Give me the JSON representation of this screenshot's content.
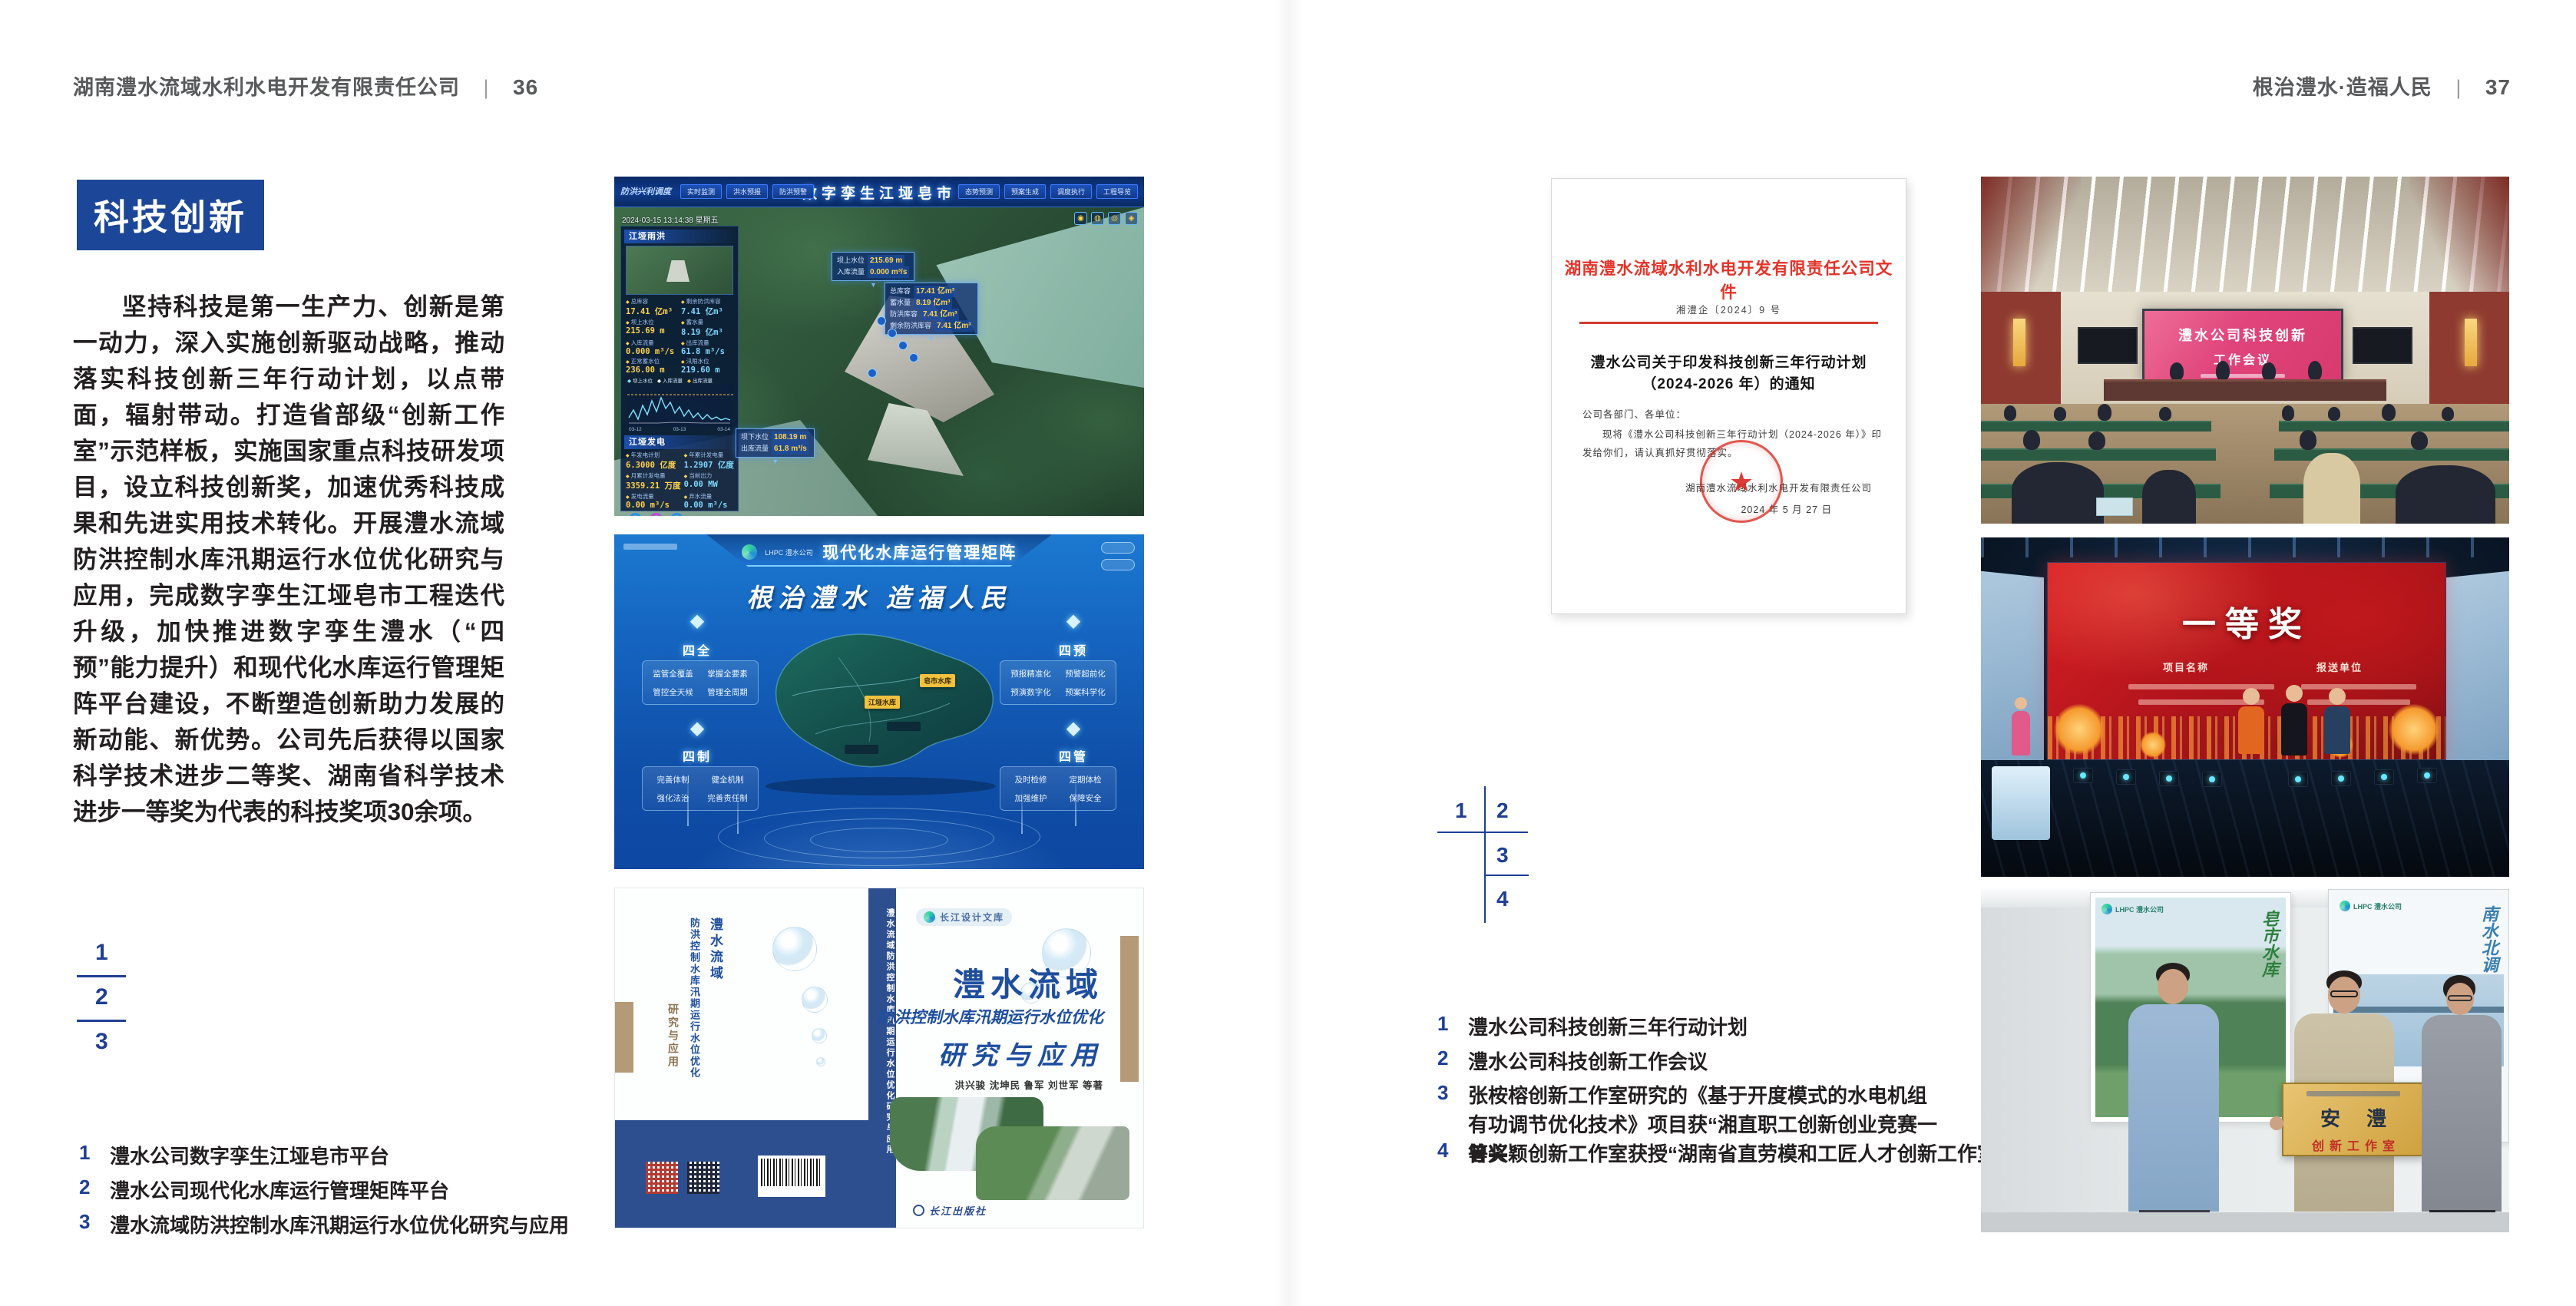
{
  "colors": {
    "accent_blue": "#1c4697",
    "key_blue": "#1f3f94",
    "doc_red": "#d93025",
    "matrix_blue": "#1565c0",
    "book_blue": "#1f4e9e",
    "screen_pink": "#e0447a",
    "award_red": "#c8181d",
    "plaque_gold": "#d4a94c"
  },
  "page_left": {
    "header": {
      "company": "湖南澧水流域水利水电开发有限责任公司",
      "sep": "|",
      "page_no": "36"
    },
    "section_title": "科技创新",
    "paragraph": "坚持科技是第一生产力、创新是第一动力，深入实施创新驱动战略，推动落实科技创新三年行动计划，以点带面，辐射带动。打造省部级“创新工作室”示范样板，实施国家重点科技研发项目，设立科技创新奖，加速优秀科技成果和先进实用技术转化。开展澧水流域防洪控制水库汛期运行水位优化研究与应用，完成数字孪生江垭皂市工程迭代升级，加快推进数字孪生澧水（“四预”能力提升）和现代化水库运行管理矩阵平台建设，不断塑造创新助力发展的新动能、新优势。公司先后获得以国家科学技术进步二等奖、湖南省科学技术进步一等奖为代表的科技奖项30余项。",
    "figure_keys": [
      "1",
      "2",
      "3"
    ],
    "captions": [
      {
        "num": "1",
        "text": "澧水公司数字孪生江垭皂市平台"
      },
      {
        "num": "2",
        "text": "澧水公司现代化水库运行管理矩阵平台"
      },
      {
        "num": "3",
        "text": "澧水流域防洪控制水库汛期运行水位优化研究与应用"
      }
    ]
  },
  "page_right": {
    "header": {
      "slogan": "根治澧水·造福人民",
      "sep": "|",
      "page_no": "37"
    },
    "figure_keys": [
      "1",
      "2",
      "3",
      "4"
    ],
    "captions": [
      {
        "num": "1",
        "text": "澧水公司科技创新三年行动计划"
      },
      {
        "num": "2",
        "text": "澧水公司科技创新工作会议"
      },
      {
        "num": "3",
        "text": "张桉榕创新工作室研究的《基于开度模式的水电机组有功调节优化技术》项目获“湘直职工创新创业竞赛一等奖”"
      },
      {
        "num": "4",
        "text": "曾兴颖创新工作室获授“湖南省直劳模和工匠人才创新工作室”"
      }
    ]
  },
  "images": {
    "dashboard": {
      "corner_label": "防洪兴利调度",
      "title": "数字孪生江垭皂市",
      "nav_left": [
        "实时监测",
        "洪水预报",
        "防洪预警"
      ],
      "nav_right": [
        "态势预测",
        "预案生成",
        "调度执行",
        "工程导览"
      ],
      "timestamp": "2024-03-15 13:14:38 星期五",
      "panel_rain": {
        "title": "江垭雨洪",
        "stats": [
          {
            "label": "总库容",
            "value": "17.41 亿m³"
          },
          {
            "label": "剩余防洪库容",
            "value": "7.41 亿m³"
          },
          {
            "label": "坝上水位",
            "value": "215.69 m"
          },
          {
            "label": "蓄水量",
            "value": "8.19 亿m³"
          },
          {
            "label": "入库流量",
            "value": "0.000 m³/s"
          },
          {
            "label": "出库流量",
            "value": "61.8 m³/s"
          },
          {
            "label": "正常蓄水位",
            "value": "236.00 m"
          },
          {
            "label": "汛限水位",
            "value": "219.60 m"
          }
        ],
        "legend": [
          "坝上水位",
          "入库流量",
          "出库流量"
        ],
        "x_ticks": [
          "03-12",
          "03-13",
          "03-14"
        ]
      },
      "panel_power": {
        "title": "江垭发电",
        "stats": [
          {
            "label": "年发电计划",
            "value": "6.3000 亿度"
          },
          {
            "label": "年累计发电量",
            "value": "1.2907 亿度"
          },
          {
            "label": "月累计发电量",
            "value": "3359.21 万度"
          },
          {
            "label": "当前出力",
            "value": "0.00 MW"
          },
          {
            "label": "发电流量",
            "value": "0.00 m³/s"
          },
          {
            "label": "弃水流量",
            "value": "0.00 m³/s"
          }
        ]
      },
      "callout_up": {
        "rows": [
          [
            "坝上水位",
            "215.69 m"
          ],
          [
            "入库流量",
            "0.000 m³/s"
          ]
        ]
      },
      "callout_res": {
        "rows": [
          [
            "总库容",
            "17.41 亿m³"
          ],
          [
            "蓄水量",
            "8.19 亿m³"
          ],
          [
            "防洪库容",
            "7.41 亿m³"
          ],
          [
            "剩余防洪库容",
            "7.41 亿m³"
          ]
        ]
      },
      "callout_down": {
        "rows": [
          [
            "坝下水位",
            "108.19 m"
          ],
          [
            "出库流量",
            "61.8 m³/s"
          ]
        ]
      }
    },
    "matrix": {
      "brand": "LHPC 澧水公司",
      "title": "现代化水库运行管理矩阵",
      "slogan": "根治澧水 造福人民",
      "map_labels": [
        "皂市水库",
        "江垭水库"
      ],
      "groups": [
        {
          "name": "四全",
          "items": [
            "监管全覆盖",
            "掌握全要素",
            "管控全天候",
            "管理全周期"
          ]
        },
        {
          "name": "四预",
          "items": [
            "预报精准化",
            "预警超前化",
            "预演数字化",
            "预案科学化"
          ]
        },
        {
          "name": "四制",
          "items": [
            "完善体制",
            "健全机制",
            "强化法治",
            "完善责任制"
          ]
        },
        {
          "name": "四管",
          "items": [
            "及时检修",
            "定期体检",
            "加强维护",
            "保障安全"
          ]
        }
      ]
    },
    "book": {
      "series": "长江设计文库",
      "title_region": "澧水流域",
      "title_sub": "防洪控制水库汛期运行水位优化",
      "title_tail": "研究与应用",
      "authors": "洪兴骏  沈坤民  鲁军  刘世军  等著",
      "publisher": "长江出版社",
      "spine_text": "澧水流域防洪控制水库汛期运行水位优化研究与应用",
      "back_col1": "澧水流域",
      "back_col2": "防洪控制水库汛期运行水位优化",
      "back_col3": "研究与应用"
    },
    "document": {
      "header": "湖南澧水流域水利水电开发有限责任公司文件",
      "doc_no": "湘澧企〔2024〕9 号",
      "title_line1": "澧水公司关于印发科技创新三年行动计划",
      "title_line2": "（2024-2026 年）的通知",
      "salutation": "公司各部门、各单位：",
      "body_line1": "现将《澧水公司科技创新三年行动计划（2024-2026 年）》印",
      "body_line2": "发给你们，请认真抓好贯彻落实。",
      "signer": "湖南澧水流域水利水电开发有限责任公司",
      "date": "2024 年 5 月 27 日"
    },
    "meeting": {
      "screen_line1": "澧水公司科技创新",
      "screen_line2": "工作会议"
    },
    "award": {
      "screen_title": "一等奖",
      "col_left": "项目名称",
      "col_right": "报送单位"
    },
    "plaque": {
      "brand": "LHPC 澧水公司",
      "line1": "安澧",
      "line2": "创新工作室",
      "poster_left_text": "皂市水库",
      "poster_right_text": "南水北调"
    }
  }
}
